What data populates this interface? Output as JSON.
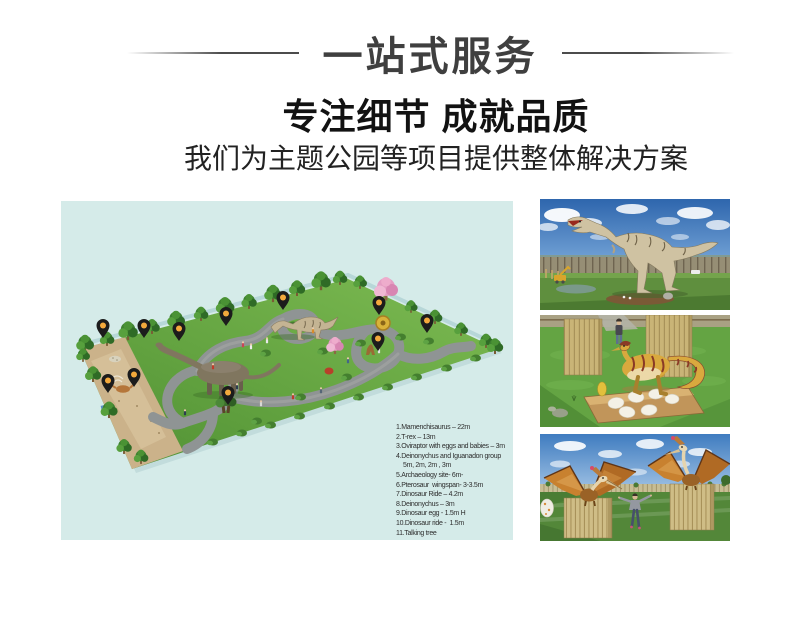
{
  "banner": {
    "title": "一站式服务"
  },
  "section": {
    "heading": "专注细节 成就品质",
    "subtitle": "我们为主题公园等项目提供整体解决方案"
  },
  "park_map": {
    "background_color": "#d5ebe9",
    "pin_color": "#f3a93c",
    "pin_count": 11,
    "legend_lines": [
      "1.Mamenchisaurus – 22m",
      "2.T-rex – 13m",
      "3.Oviraptor with eggs and babies – 3m",
      "4.Deinonychus and Iguanadon group",
      "5m, 2m, 2m , 3m",
      "5.Archaeology site- 6m-",
      "6.Pterosaur  wingspan- 3-3.5m",
      "7.Dinosaur Ride – 4.2m",
      "8.Deinonychus – 3m",
      "9.Dinosaur egg - 1.5m H",
      "10.Dinosaur ride -  1.5m",
      "11.Talking tree"
    ]
  }
}
